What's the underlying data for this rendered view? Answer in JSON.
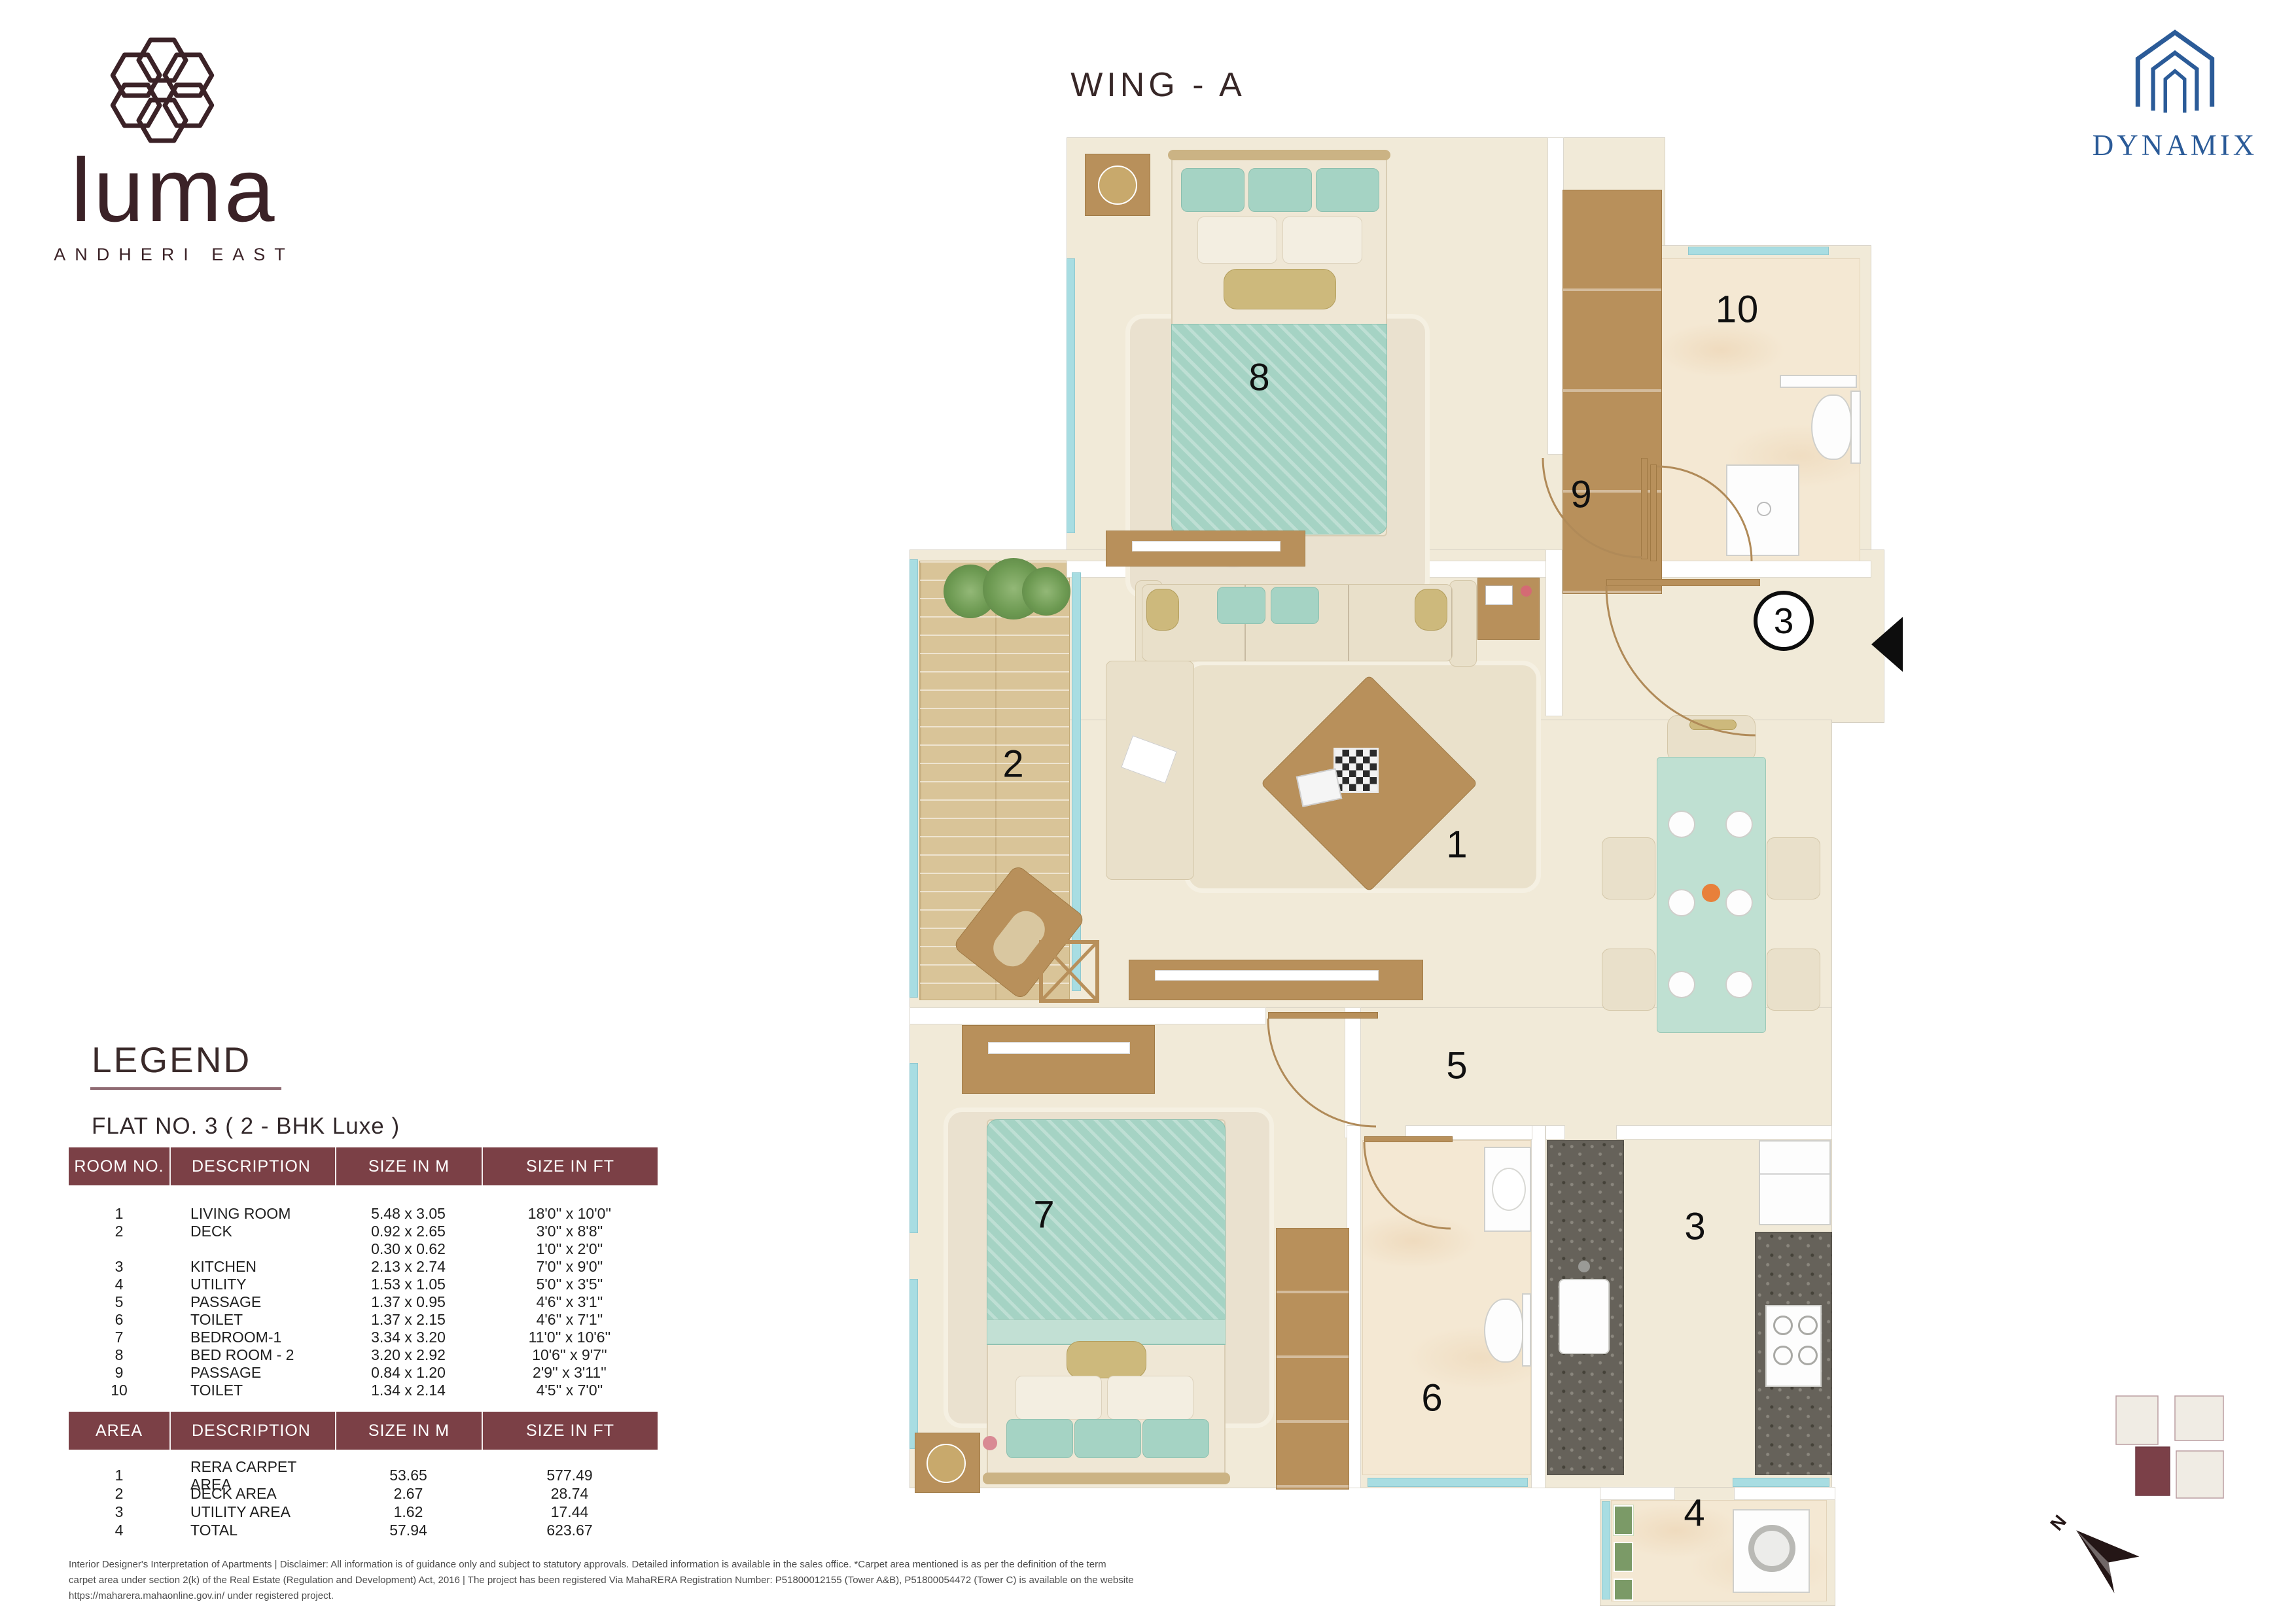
{
  "header": {
    "wing_title": "WING - A",
    "luma": {
      "wordmark": "luma",
      "subtitle": "ANDHERI EAST"
    },
    "developer": {
      "name": "DYNAMIX"
    }
  },
  "legend": {
    "title": "LEGEND",
    "flat_title": "FLAT NO. 3 ( 2 - BHK Luxe )",
    "room_table": {
      "headers": [
        "ROOM NO.",
        "DESCRIPTION",
        "SIZE IN M",
        "SIZE IN FT"
      ],
      "rows": [
        {
          "no": "1",
          "desc": "LIVING ROOM",
          "m": "5.48  x  3.05",
          "ft": "18'0''  x  10'0''"
        },
        {
          "no": "2",
          "desc": "DECK",
          "m": "0.92  x  2.65",
          "ft": "3'0''  x  8'8''"
        },
        {
          "no": "",
          "desc": "",
          "m": "0.30  x  0.62",
          "ft": "1'0''  x  2'0''"
        },
        {
          "no": "3",
          "desc": "KITCHEN",
          "m": "2.13  x  2.74",
          "ft": "7'0''  x  9'0''"
        },
        {
          "no": "4",
          "desc": "UTILITY",
          "m": "1.53  x  1.05",
          "ft": "5'0''  x  3'5''"
        },
        {
          "no": "5",
          "desc": "PASSAGE",
          "m": "1.37  x  0.95",
          "ft": "4'6''  x  3'1''"
        },
        {
          "no": "6",
          "desc": "TOILET",
          "m": "1.37  x  2.15",
          "ft": "4'6''  x  7'1''"
        },
        {
          "no": "7",
          "desc": "BEDROOM-1",
          "m": "3.34  x  3.20",
          "ft": "11'0''  x  10'6''"
        },
        {
          "no": "8",
          "desc": "BED ROOM - 2",
          "m": "3.20  x  2.92",
          "ft": "10'6''  x  9'7''"
        },
        {
          "no": "9",
          "desc": "PASSAGE",
          "m": "0.84  x  1.20",
          "ft": "2'9''  x  3'11''"
        },
        {
          "no": "10",
          "desc": "TOILET",
          "m": "1.34  x  2.14",
          "ft": "4'5''  x  7'0''"
        }
      ]
    },
    "area_table": {
      "headers": [
        "AREA",
        "DESCRIPTION",
        "SIZE IN M",
        "SIZE IN FT"
      ],
      "rows": [
        {
          "no": "1",
          "desc": "RERA CARPET AREA",
          "m": "53.65",
          "ft": "577.49"
        },
        {
          "no": "2",
          "desc": "DECK AREA",
          "m": "2.67",
          "ft": "28.74"
        },
        {
          "no": "3",
          "desc": "UTILITY AREA",
          "m": "1.62",
          "ft": "17.44"
        },
        {
          "no": "4",
          "desc": "TOTAL",
          "m": "57.94",
          "ft": "623.67"
        }
      ]
    }
  },
  "plan": {
    "rooms": [
      {
        "label": "1",
        "name": "LIVING ROOM"
      },
      {
        "label": "2",
        "name": "DECK"
      },
      {
        "label": "3",
        "name": "KITCHEN"
      },
      {
        "label": "4",
        "name": "UTILITY"
      },
      {
        "label": "5",
        "name": "PASSAGE"
      },
      {
        "label": "6",
        "name": "TOILET"
      },
      {
        "label": "7",
        "name": "BEDROOM-1"
      },
      {
        "label": "8",
        "name": "BED ROOM - 2"
      },
      {
        "label": "9",
        "name": "PASSAGE"
      },
      {
        "label": "10",
        "name": "TOILET"
      }
    ],
    "entrance_flat_number": "3",
    "north_label": "N"
  },
  "disclaimer": {
    "line1": "Interior Designer's Interpretation of Apartments | Disclaimer: All information is of guidance only and subject to statutory approvals. Detailed information is available in the sales office. *Carpet area mentioned is as per the definition of the term",
    "line2": "carpet area under section 2(k) of the Real Estate (Regulation and Development) Act, 2016 | The project has been registered Via MahaRERA Registration Number: P51800012155 (Tower A&B), P51800054472 (Tower C) is available on the website",
    "line3": "https://maharera.mahaonline.gov.in/ under registered project."
  },
  "colors": {
    "table_header_maroon": "#7b4046",
    "developer_blue": "#2b5b98",
    "logo_brown": "#3b2227",
    "floor_cream": "#f1ead8",
    "window_teal": "#a8dde2",
    "bedding_teal": "#a5d3c4",
    "wood_brown": "#b8905b",
    "keyplan_highlight": "#7b4048"
  }
}
